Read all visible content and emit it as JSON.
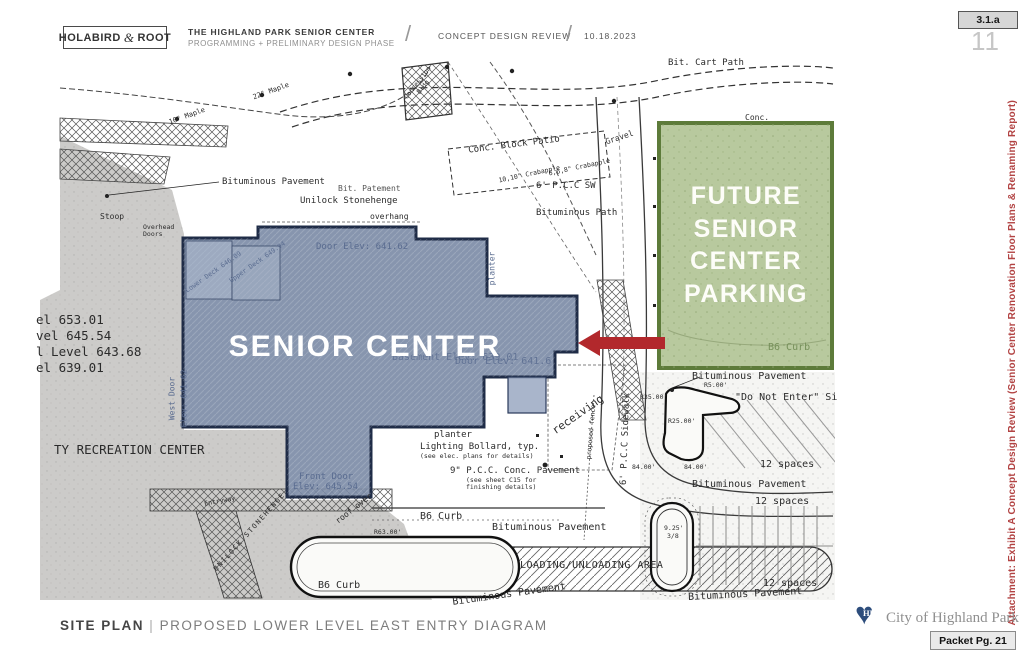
{
  "header": {
    "logo_left": "HOLABIRD",
    "logo_amp": "&",
    "logo_right": "ROOT",
    "title": "THE HIGHLAND PARK SENIOR CENTER",
    "subtitle": "PROGRAMMING + PRELIMINARY DESIGN PHASE",
    "separator": "/",
    "review": "CONCEPT DESIGN REVIEW",
    "date": "10.18.2023",
    "attachment_tag": "3.1.a",
    "page_number": "11"
  },
  "sidebar": {
    "attachment_note": "Attachment: Exhibit A Concept Design Review  (Senior Center Renovation Floor Plans & Renaming Report)"
  },
  "footer": {
    "section": "SITE PLAN",
    "divider": "|",
    "description": "PROPOSED LOWER LEVEL EAST ENTRY DIAGRAM",
    "city": "City of Highland Park",
    "logo_initials": "HP",
    "packet": "Packet Pg. 21"
  },
  "plan": {
    "building_label": "SENIOR CENTER",
    "parking_label_lines": [
      "FUTURE",
      "SENIOR",
      "CENTER",
      "PARKING"
    ],
    "colors": {
      "building_fill": "#7a8aa5",
      "building_border": "#1f2c47",
      "parking_fill": "#b2c496",
      "parking_border": "#5d7b3a",
      "arrow_red": "#b2282c",
      "attachment_red": "#b24343",
      "heart_navy": "#2d4d7c"
    },
    "labels": {
      "bit_cart_path": "Bit. Cart Path",
      "conc_top": "Conc.",
      "gravel": "Gravel",
      "conc_block_patio": "Conc. Block Patio",
      "crab_1": "10,10\" Crabapple",
      "crab_2": "6,6,8\" Crabapple",
      "pcc_sw": "6' P.C.C SW",
      "bituminous_path": "Bituminous Path",
      "bituminous_pavement_nw": "Bituminous Pavement",
      "bit_patement": "Bit. Patement",
      "unilock_stonehenge": "Unilock Stonehenge",
      "overhang": "overhang",
      "stoop": "Stoop",
      "overhead_doors": "Overhead Doors",
      "door_elev_top": "Door Elev: 641.62",
      "planter_east": "planter",
      "lower_deck": "Lower Deck 646.09",
      "upper_deck": "Upper Deck 649.94",
      "level_1": "el 653.01",
      "level_2": "vel 645.54",
      "level_3": "l Level 643.68",
      "level_4": "el 639.01",
      "west_door_1": "West Door",
      "west_door_2": "Elev: 641.62",
      "basement_elev": "Basement Elev: 639.01",
      "door_elev_east": "Door Elev: 641.6",
      "recreation_center": "TY RECREATION CENTER",
      "receiving": "receiving",
      "pcc_sidewalk": "6' P.C.C Sidewalk",
      "planter_south": "planter",
      "lighting_bollard": "Lighting Bollard, typ.",
      "lighting_bollard_note": "(see elec. plans for details)",
      "pcc_conc_pavement": "9\" P.C.C. Conc. Pavement",
      "pcc_conc_note": "(see sheet C15 for finishing details)",
      "front_door_1": "Front Door",
      "front_door_2": "Elev: 645.54",
      "b6_curb_mid": "B6 Curb",
      "bituminous_pavement_mid": "Bituminous Pavement",
      "loading_area": "LOADING/UNLOADING AREA",
      "b6_curb_sw": "B6 Curb",
      "bituminous_pavement_s": "Bituminous Pavement",
      "bituminous_pavement_e1": "Bituminous Pavement",
      "do_not_enter": "\"Do Not Enter\" Si",
      "spaces_1": "12 spaces",
      "bituminous_pavement_e2": "Bituminous Pavement",
      "spaces_2": "12 spaces",
      "dim_925": "9.25'",
      "dim_38": "3/8",
      "spaces_3": "12 spaces",
      "bituminous_pavement_e3": "Bituminous Pavement",
      "b6_curb_green": "B6 Curb",
      "concession_bldg": "Concession Bldg",
      "unilock_caps": "UNILOCK STONEHENGE",
      "entryway": "Entryway",
      "maple_10": "10\" Maple",
      "maple_22": "22\" Maple",
      "roof_over": "roof over",
      "proposed_fence": "proposed fence",
      "r35": "R35.00'",
      "r25": "R25.00'",
      "r5": "R5.00'",
      "dim_84_a": "84.00'",
      "dim_84_b": "84.00'",
      "r63": "R63.00'"
    }
  }
}
